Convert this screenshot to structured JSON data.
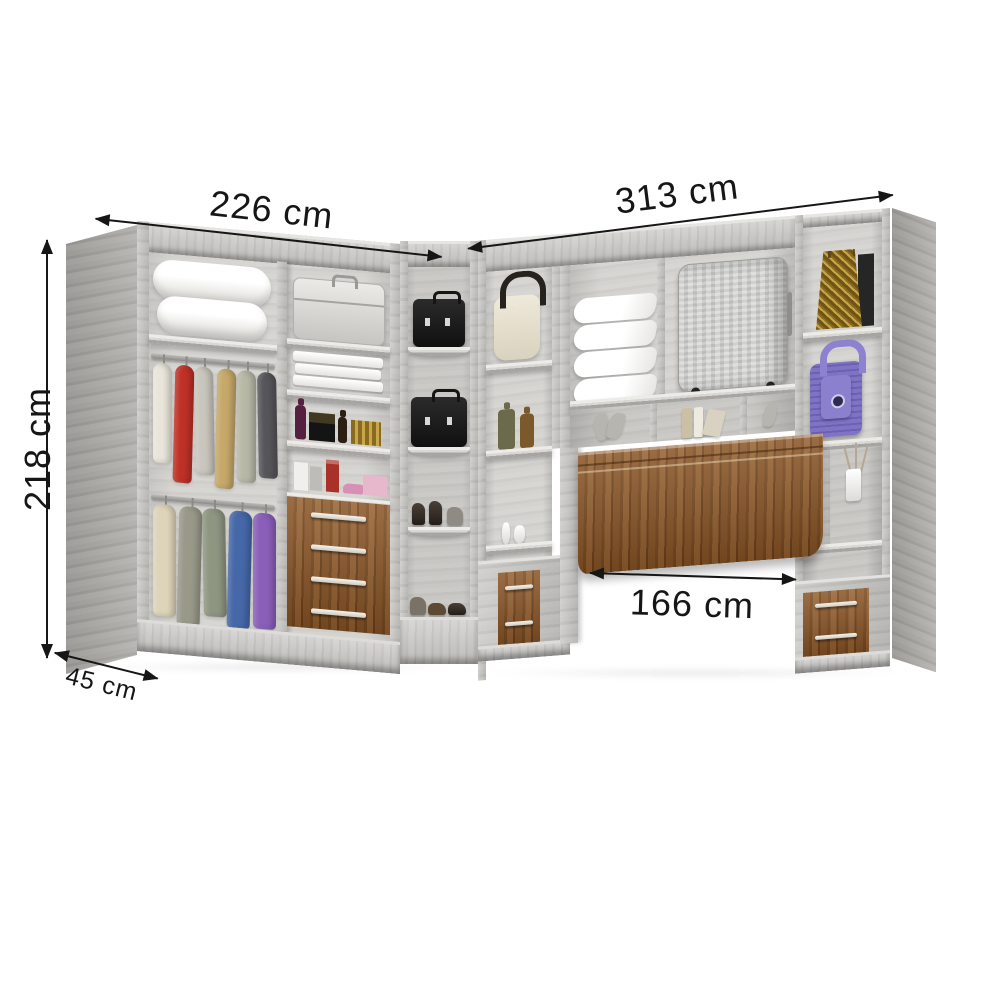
{
  "product": {
    "type": "L-shaped corner closet wardrobe with fold-down bed",
    "finish_main": "light gray rustic wood",
    "finish_accent": "brown rustic wood"
  },
  "dimensions": {
    "left_width": "226 cm",
    "right_width": "313 cm",
    "height": "218 cm",
    "depth": "45 cm",
    "bed_width": "166 cm"
  },
  "colors": {
    "background": "#ffffff",
    "annotation": "#161616",
    "wood_light": "#c7c6c3",
    "wood_side": "#a8a6a3",
    "wood_interior": "#d3d2cf",
    "wood_brown": "#8a5526",
    "handle": "#f1eee7"
  },
  "contents": {
    "left_section": [
      "duvet",
      "hanging clothes top rail",
      "hanging clothes bottom rail",
      "suitcase",
      "folded linens",
      "perfume bottles",
      "accessories",
      "four-drawer chest"
    ],
    "corner_unit": [
      "briefcase",
      "briefcase",
      "high heels",
      "shoes"
    ],
    "right_section": [
      "cream handbag",
      "bottles",
      "small vases",
      "pillow stack",
      "hard-shell suitcase",
      "leaf decor",
      "books",
      "ornament",
      "fold-down bed panel",
      "gold bag",
      "purple handbag",
      "flower vase",
      "two-drawer nightstand left",
      "two-drawer nightstand right"
    ],
    "clothes_rail_top_colors": [
      "#e9e5db",
      "#bf3127",
      "#c9c6bd",
      "#c6a869",
      "#b7b9a6",
      "#56565a"
    ],
    "clothes_rail_bottom_colors": [
      "#ded4b9",
      "#99998a",
      "#8e9682",
      "#4668a9",
      "#8a5fb9"
    ]
  }
}
